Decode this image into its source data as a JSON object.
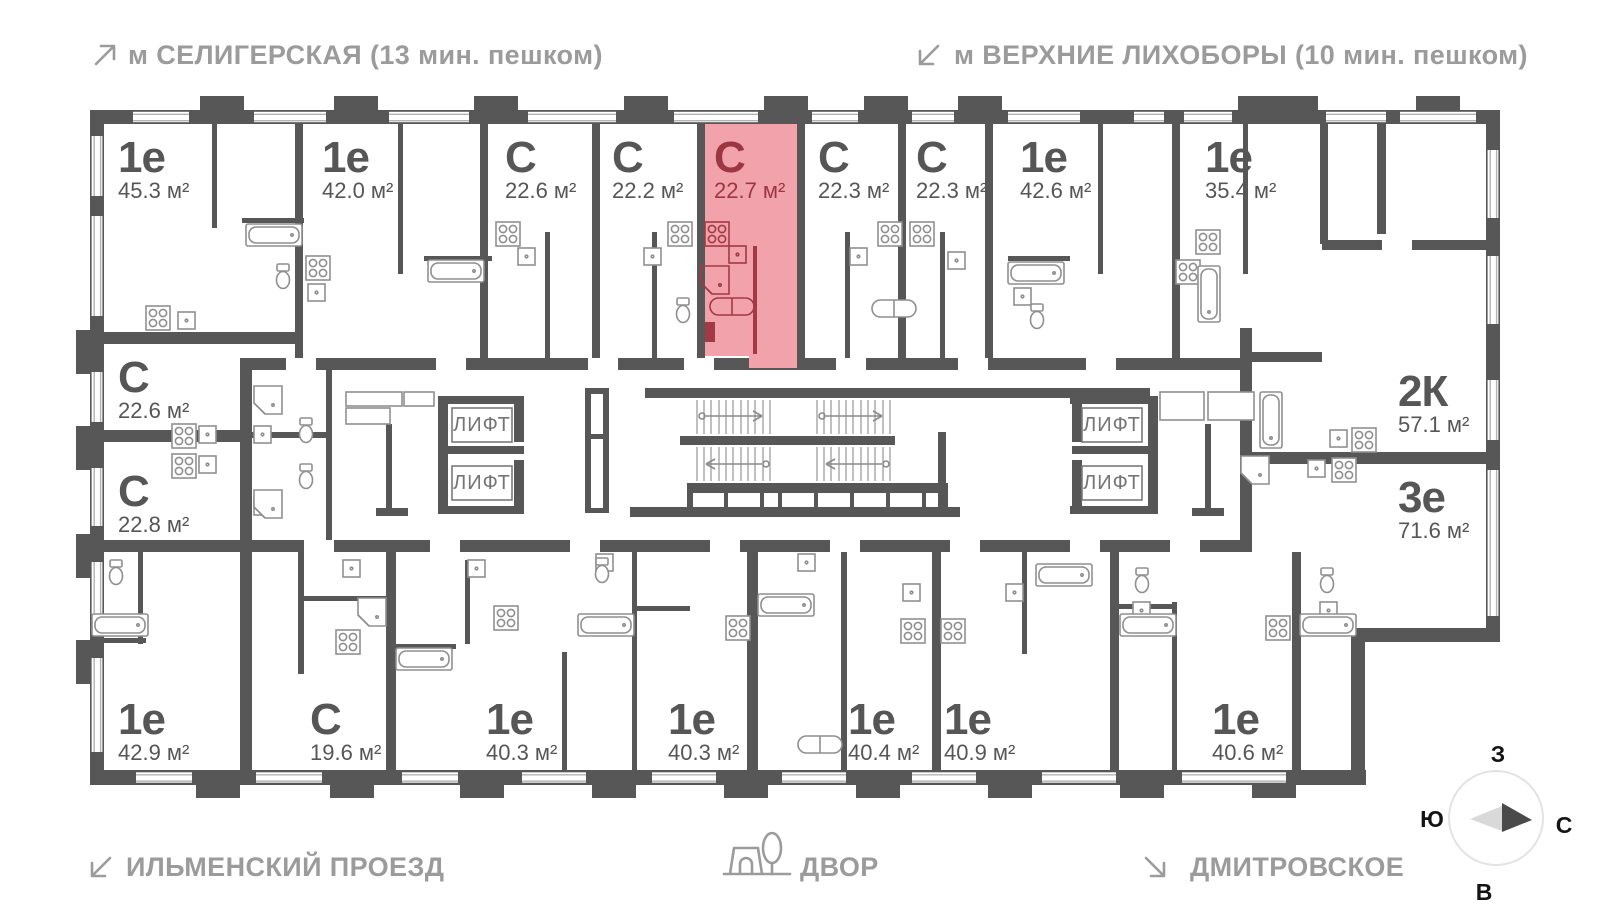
{
  "header": {
    "metro_left": "м СЕЛИГЕРСКАЯ (13 мин. пешком)",
    "metro_right": "м ВЕРХНИЕ ЛИХОБОРЫ (10 мин. пешком)"
  },
  "footer": {
    "street_left": "ИЛЬМЕНСКИЙ ПРОЕЗД",
    "courtyard": "ДВОР",
    "street_right": "ДМИТРОВСКОЕ"
  },
  "compass": {
    "west": "З",
    "south": "Ю",
    "north": "С",
    "east": "В"
  },
  "plan": {
    "elevator_label": "ЛИФТ"
  },
  "colors": {
    "wall": "#575757",
    "highlight_fill": "#f2a2ab",
    "highlight_text": "#9c3642",
    "label_text": "#565656",
    "muted_text": "#9b9b9b"
  },
  "units": [
    {
      "id": "1e-45-3",
      "type": "1е",
      "area": "45.3 м²",
      "highlighted": false
    },
    {
      "id": "1e-42-0",
      "type": "1е",
      "area": "42.0 м²",
      "highlighted": false
    },
    {
      "id": "s-22-6-top",
      "type": "С",
      "area": "22.6 м²",
      "highlighted": false
    },
    {
      "id": "s-22-2",
      "type": "С",
      "area": "22.2 м²",
      "highlighted": false
    },
    {
      "id": "s-22-7",
      "type": "С",
      "area": "22.7 м²",
      "highlighted": true
    },
    {
      "id": "s-22-3-a",
      "type": "С",
      "area": "22.3 м²",
      "highlighted": false
    },
    {
      "id": "s-22-3-b",
      "type": "С",
      "area": "22.3 м²",
      "highlighted": false
    },
    {
      "id": "1e-42-6",
      "type": "1е",
      "area": "42.6 м²",
      "highlighted": false
    },
    {
      "id": "1e-35-4",
      "type": "1е",
      "area": "35.4 м²",
      "highlighted": false
    },
    {
      "id": "2k-57-1",
      "type": "2К",
      "area": "57.1 м²",
      "highlighted": false
    },
    {
      "id": "3e-71-6",
      "type": "3е",
      "area": "71.6 м²",
      "highlighted": false
    },
    {
      "id": "s-22-6-left",
      "type": "С",
      "area": "22.6 м²",
      "highlighted": false
    },
    {
      "id": "s-22-8",
      "type": "С",
      "area": "22.8 м²",
      "highlighted": false
    },
    {
      "id": "1e-42-9",
      "type": "1е",
      "area": "42.9 м²",
      "highlighted": false
    },
    {
      "id": "s-19-6",
      "type": "С",
      "area": "19.6 м²",
      "highlighted": false
    },
    {
      "id": "1e-40-3-a",
      "type": "1е",
      "area": "40.3 м²",
      "highlighted": false
    },
    {
      "id": "1e-40-3-b",
      "type": "1е",
      "area": "40.3 м²",
      "highlighted": false
    },
    {
      "id": "1e-40-4",
      "type": "1е",
      "area": "40.4 м²",
      "highlighted": false
    },
    {
      "id": "1e-40-9",
      "type": "1е",
      "area": "40.9 м²",
      "highlighted": false
    },
    {
      "id": "1e-40-6",
      "type": "1е",
      "area": "40.6 м²",
      "highlighted": false
    }
  ]
}
